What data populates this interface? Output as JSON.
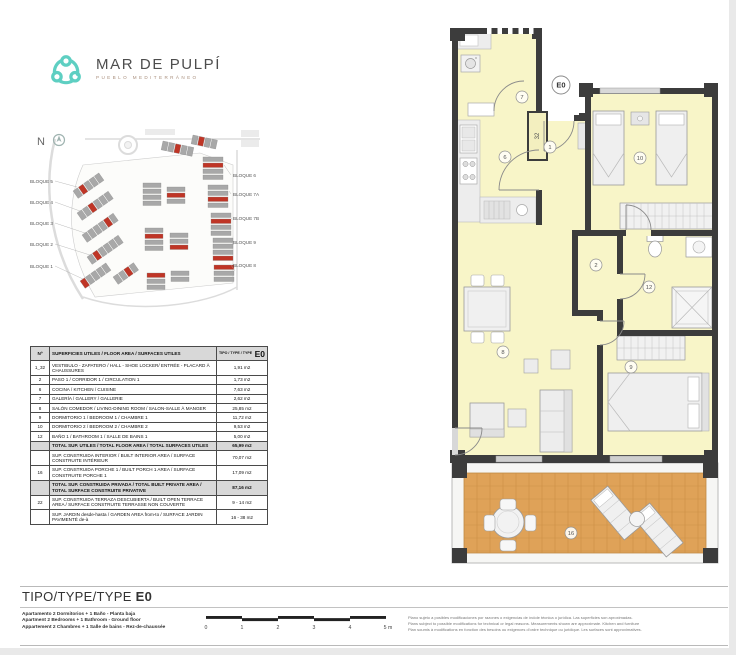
{
  "logo": {
    "title": "MAR DE PULPÍ",
    "subtitle": "PUEBLO MEDITERRÁNEO",
    "brand_color": "#5ecfc2"
  },
  "site_plan": {
    "north_label": "N",
    "blocks_left": [
      "BLOQUE 5",
      "BLOQUE 4",
      "BLOQUE 3",
      "BLOQUE 2",
      "BLOQUE 1"
    ],
    "blocks_right": [
      "BLOQUE 6",
      "BLOQUE 7A",
      "BLOQUE 7B",
      "BLOQUE 9",
      "BLOQUE 8"
    ],
    "highlight_color": "#bf3526"
  },
  "area_table": {
    "header": {
      "col_no": "Nº",
      "col_desc": "SUPERFICIES UTILES / FLOOR AREA / SURFACES UTILES",
      "col_type": "TIPO / TYPE / TYPE",
      "type_value": "E0"
    },
    "rows": [
      {
        "no": "1_32",
        "desc": "VESTIBULO - ZAPATERO / HALL - SHOE LOCKER/ ENTRÉE - PLACARD À CHAUSSURES",
        "value": "1,91 m2"
      },
      {
        "no": "2",
        "desc": "PASO 1 / CORRIDOR 1 / CIRCULATION 1",
        "value": "1,73 m2"
      },
      {
        "no": "6",
        "desc": "COCINA / KITCHEN / CUISINE",
        "value": "7,63 m2"
      },
      {
        "no": "7",
        "desc": "GALERÍA / GALLERY / GALLERIE",
        "value": "2,62 m2"
      },
      {
        "no": "8",
        "desc": "SALÓN COMEDOR / LIVING-DINING ROOM / SALON-SALLE À MANGER",
        "value": "25,85 m2"
      },
      {
        "no": "9",
        "desc": "DORMITORIO 1 / BEDROOM 1 / CHAMBRE 1",
        "value": "11,72 m2"
      },
      {
        "no": "10",
        "desc": "DORMITORIO 2 / BEDROOM 2 / CHAMBRE 2",
        "value": "9,53 m2"
      },
      {
        "no": "12",
        "desc": "BAÑO 1 / BATHROOM 1 / SALLE DE BAINS 1",
        "value": "5,00 m2"
      },
      {
        "no": "",
        "desc": "TOTAL SUP. UTILES / TOTAL FLOOR AREA / TOTAL SURFACES UTILES",
        "value": "65,99 m2"
      },
      {
        "no": "",
        "desc": "SUP. CONSTRUIDA INTERIOR / BUILT INTERIOR AREA / SURFACE CONSTRUITE INTÉRIEUR",
        "value": "70,07 m2"
      },
      {
        "no": "16",
        "desc": "SUP. CONSTRUIDA PORCHE 1 / BUILT PORCH 1 AREA / SURFACE CONSTRUITE PORCHE 1",
        "value": "17,09 m2"
      },
      {
        "no": "",
        "desc": "TOTAL SUP. CONSTRUIDA PRIVADA / TOTAL BUILT PRIVATE AREA / TOTAL SURFACE CONSTRUITE PRIVATIVE",
        "value": "87,16 m2"
      },
      {
        "no": "22",
        "desc": "SUP. CONSTRUIDA TERRAZA DESCUBIERTA / BUILT OPEN TERRACE AREA / SURFACE CONSTRUITE TERRASSE NON COUVERTE",
        "value": "9 - 14 m2"
      },
      {
        "no": "",
        "desc": "SUP. JARDIN desde-hasta / GARDEN AREA from-to / SURFACE JARDIN PAVIMENTÉ de-à",
        "value": "16 - 38 m2"
      }
    ]
  },
  "floor_plan": {
    "labels": {
      "e0": "E0",
      "r1": "1",
      "r2": "2",
      "r6": "6",
      "r7": "7",
      "r8": "8",
      "r9": "9",
      "r10": "10",
      "r12": "12",
      "r16": "16",
      "shaft": "32"
    },
    "colors": {
      "wall": "#3c3c3c",
      "floor": "#f8f5c8",
      "terrace": "#dfa258",
      "furniture": "#ededed"
    }
  },
  "footer": {
    "title": "TIPO/TYPE/TYPE",
    "type_value": "E0",
    "description_lines": [
      "Apartamento 2 Dormitorios + 1 Baño - Planta baja",
      "Apartment 2 Bedrooms + 1 Bathroom - Ground floor",
      "Appartement 2 Chambres + 1 Salle de bains - Rez-de-chaussée"
    ],
    "scale_labels": [
      "0",
      "1",
      "2",
      "3",
      "4",
      "5 m"
    ],
    "disclaimer_lines": [
      "Plano sujeto a posibles modificaciones por razones o exigencias de índole técnica o jurídica. Las superficies son aproximadas.",
      "Plans subject to possible modifications for technical or legal reasons. Measurements shown are approximate. Kitchen and furniture",
      "Plan soumis à modifications en fonction des besoins ou exigences d'ordre technique ou juridique. Les surfaces sont approximatives."
    ]
  }
}
